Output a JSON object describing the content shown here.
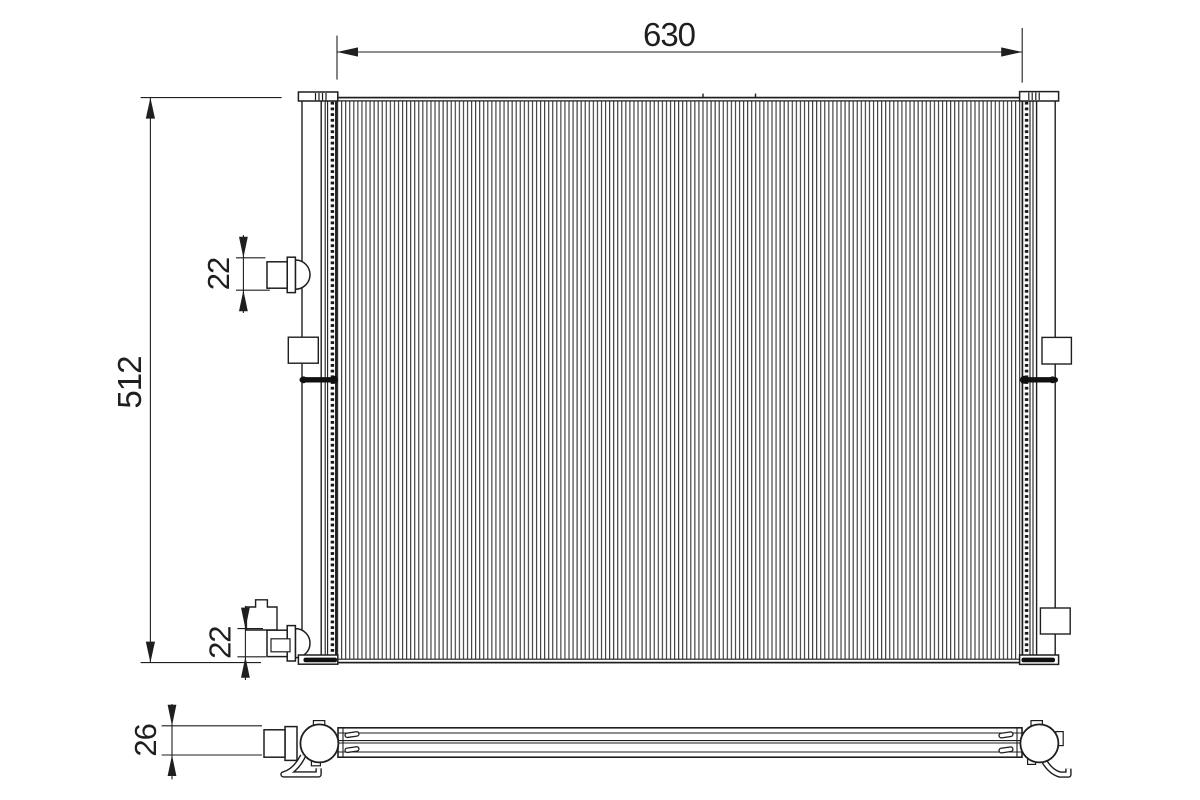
{
  "drawing": {
    "kind": "condenser-technical-drawing",
    "dimensions": {
      "width": "630",
      "height": "512",
      "port_top": "22",
      "port_bottom": "22",
      "depth": "26"
    },
    "colors": {
      "line": "#1f1f1f",
      "fin_line": "#3b3b3b",
      "fill": "#ffffff",
      "fitting_dark": "#101010"
    }
  }
}
